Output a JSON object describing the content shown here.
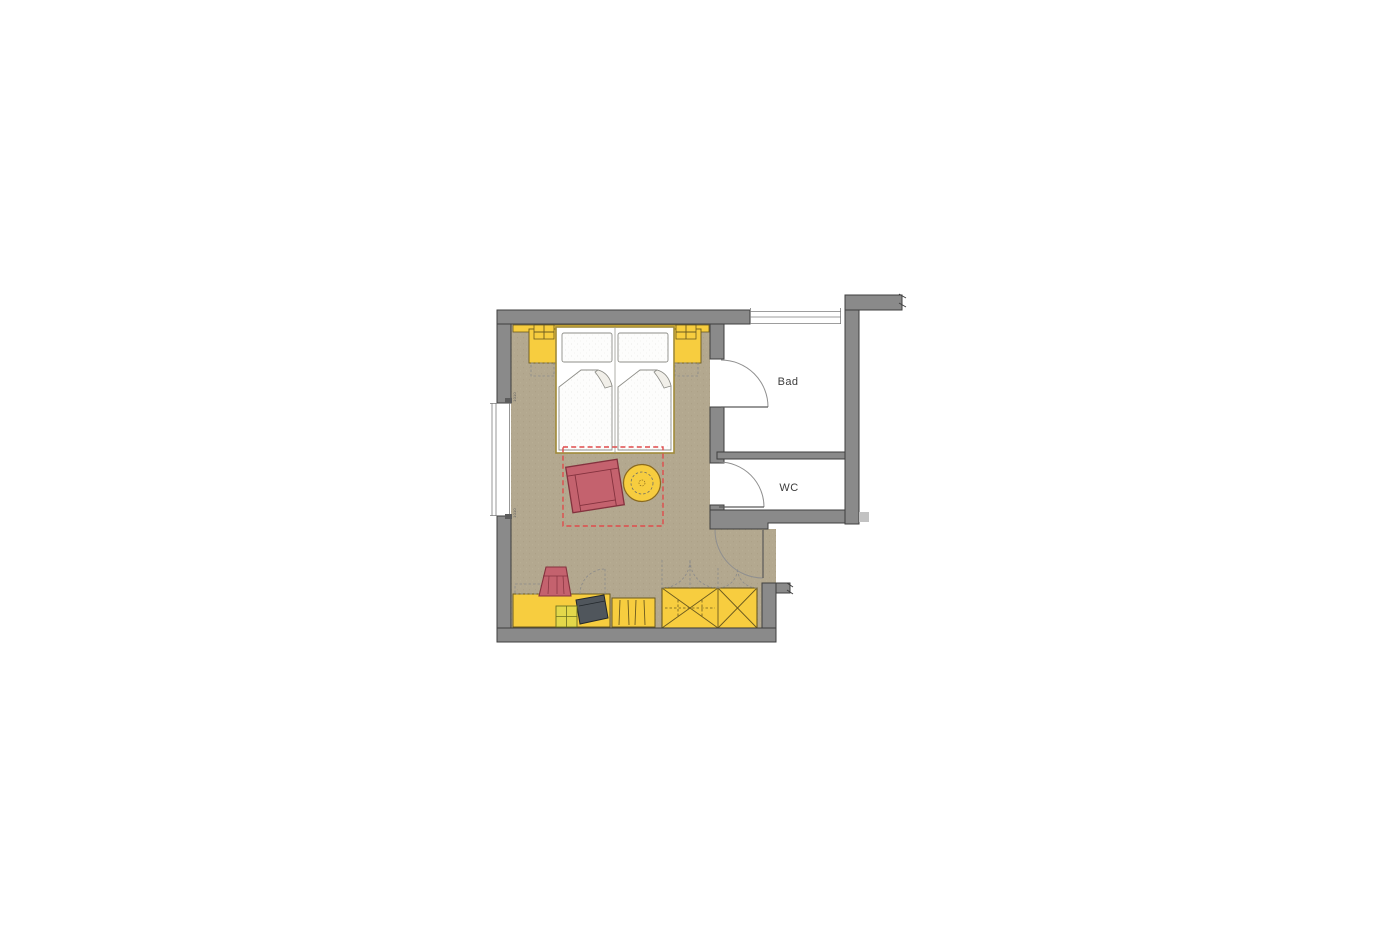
{
  "rooms": {
    "bad": {
      "label": "Bad"
    },
    "wc": {
      "label": "WC"
    }
  },
  "dimensions": {
    "window_label_top": "1010",
    "window_label_bottom": "1010"
  },
  "colors": {
    "wall_fill": "#8a8a8a",
    "wall_outline": "#3f3f3f",
    "bedroom_floor_tan": "#b3a88f",
    "furniture_yellow": "#f7cd3f",
    "furniture_outline": "#6b5a1f",
    "upholstery_red": "#c4626e",
    "upholstery_outline": "#84323e",
    "layout_zone_dashed_red": "#e04b4b",
    "tv_dark_gray": "#50565c",
    "wet_room_floor": "#ffffff",
    "label_text": "#3c3c3c"
  }
}
